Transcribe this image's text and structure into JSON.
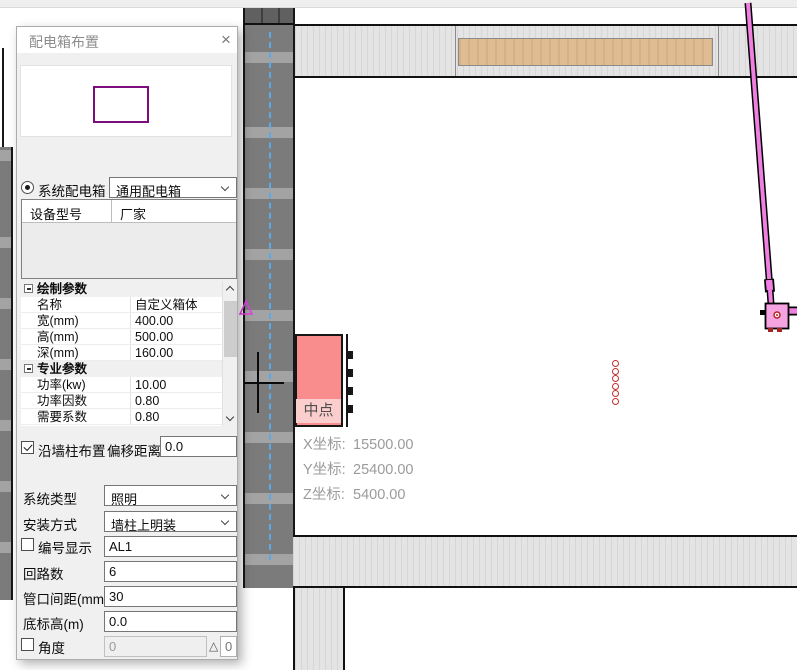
{
  "window": {
    "title": "配电箱布置",
    "close": "×"
  },
  "source_select": {
    "system_radio_label": "系统配电箱",
    "system_combo_value": "通用配电箱",
    "custom_radio_label": "自定义配电箱",
    "custom_combo_value": "PZ30-10",
    "custom_more_label": ">>"
  },
  "device_table": {
    "headers": [
      "设备型号",
      "厂家"
    ],
    "rows": []
  },
  "property_grid": {
    "groups": [
      {
        "label": "绘制参数",
        "rows": [
          {
            "name": "名称",
            "value": "自定义箱体"
          },
          {
            "name": "宽(mm)",
            "value": "400.00"
          },
          {
            "name": "高(mm)",
            "value": "500.00"
          },
          {
            "name": "深(mm)",
            "value": "160.00"
          }
        ]
      },
      {
        "label": "专业参数",
        "rows": [
          {
            "name": "功率(kw)",
            "value": "10.00"
          },
          {
            "name": "功率因数",
            "value": "0.80"
          },
          {
            "name": "需要系数",
            "value": "0.80"
          }
        ]
      }
    ]
  },
  "placement": {
    "wall_checkbox_label": "沿墙柱布置",
    "offset_label": "偏移距离:",
    "offset_value": "0.0"
  },
  "fields": {
    "system_type_label": "系统类型",
    "system_type_value": "照明",
    "install_label": "安装方式",
    "install_value": "墙柱上明装",
    "number_label": "编号显示",
    "number_value": "AL1",
    "circuits_label": "回路数",
    "circuits_value": "6",
    "spacing_label": "管口间距(mm)",
    "spacing_value": "30",
    "elevation_label": "底标高(m)",
    "elevation_value": "0.0",
    "angle_label": "角度",
    "angle_value": "0",
    "angle_delta": "△",
    "angle_value2": "0"
  },
  "canvas": {
    "tooltip": "中点",
    "coordinates": [
      {
        "label": "X坐标:",
        "value": "15500.00"
      },
      {
        "label": "Y坐标:",
        "value": "25400.00"
      },
      {
        "label": "Z坐标:",
        "value": "5400.00"
      }
    ]
  },
  "colors": {
    "accent_purple": "#7b0e7b",
    "preview_box_pink": "#f98c8c",
    "conduit_pink": "#ef7fe1",
    "device_pink": "#f5a3e1",
    "wood_tan": "#dfbc92",
    "coord_text_gray": "#9b9b9b",
    "centerline_blue": "#5aa9e8"
  }
}
